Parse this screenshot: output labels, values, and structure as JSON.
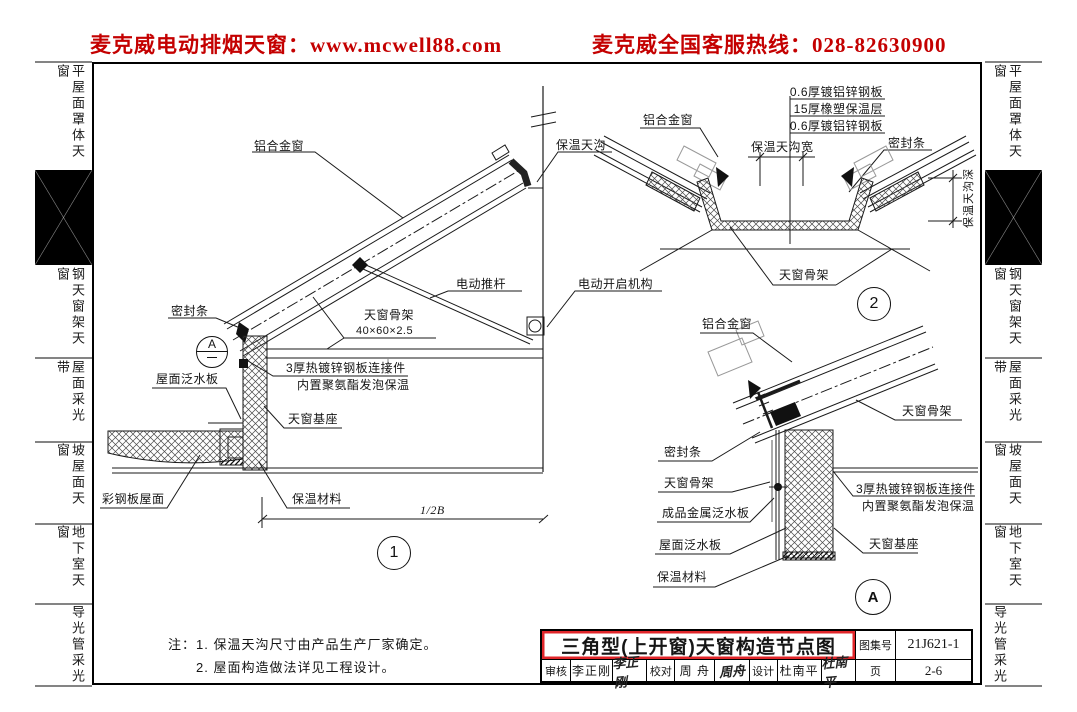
{
  "header": {
    "left": "麦克威电动排烟天窗：www.mcwell88.com",
    "right": "麦克威全国客服热线：028-82630900",
    "accent_color": "#c40000"
  },
  "sidebar": {
    "items": [
      {
        "label": "平屋面罩体天窗"
      },
      {
        "label": "钢天窗架天窗"
      },
      {
        "label": "屋面采光带"
      },
      {
        "label": "坡屋面天窗"
      },
      {
        "label": "地下室天窗"
      },
      {
        "label": "导光管采光"
      }
    ]
  },
  "d1": {
    "aluminum_window": "铝合金窗",
    "insulated_gutter": "保温天沟",
    "push_rod": "电动推杆",
    "opener": "电动开启机构",
    "seal": "密封条",
    "frame": "天窗骨架",
    "frame_size": "40×60×2.5",
    "connector1": "3厚热镀锌钢板连接件",
    "connector2": "内置聚氨酯发泡保温",
    "roof_flashing": "屋面泛水板",
    "base": "天窗基座",
    "steel_roof": "彩钢板屋面",
    "insulation": "保温材料",
    "dim": "1/2B",
    "detail_ref": "A",
    "num": "1"
  },
  "d2": {
    "layer1": "0.6厚镀铝锌钢板",
    "layer2": "15厚橡塑保温层",
    "layer3": "0.6厚镀铝锌钢板",
    "aluminum_window": "铝合金窗",
    "gutter_width": "保温天沟宽",
    "seal": "密封条",
    "gutter_depth": "保温天沟深",
    "frame": "天窗骨架",
    "num": "2"
  },
  "da": {
    "aluminum_window": "铝合金窗",
    "frame_right": "天窗骨架",
    "seal": "密封条",
    "frame_left": "天窗骨架",
    "metal_flashing": "成品金属泛水板",
    "roof_flashing": "屋面泛水板",
    "insulation": "保温材料",
    "connector1": "3厚热镀锌钢板连接件",
    "connector2": "内置聚氨酯发泡保温",
    "base": "天窗基座",
    "num": "A"
  },
  "notes": {
    "prefix": "注：",
    "item1": "1. 保温天沟尺寸由产品生产厂家确定。",
    "item2": "2. 屋面构造做法详见工程设计。"
  },
  "titleblock": {
    "title": "三角型(上开窗)天窗构造节点图",
    "atlas_label": "图集号",
    "atlas_no": "21J621-1",
    "review_label": "审核",
    "review_name": "李正刚",
    "review_sig": "李正刚",
    "proof_label": "校对",
    "proof_name": "周 舟",
    "proof_sig": "周舟",
    "design_label": "设计",
    "design_name": "杜南平",
    "design_sig": "杜南平",
    "page_label": "页",
    "page_no": "2-6"
  }
}
